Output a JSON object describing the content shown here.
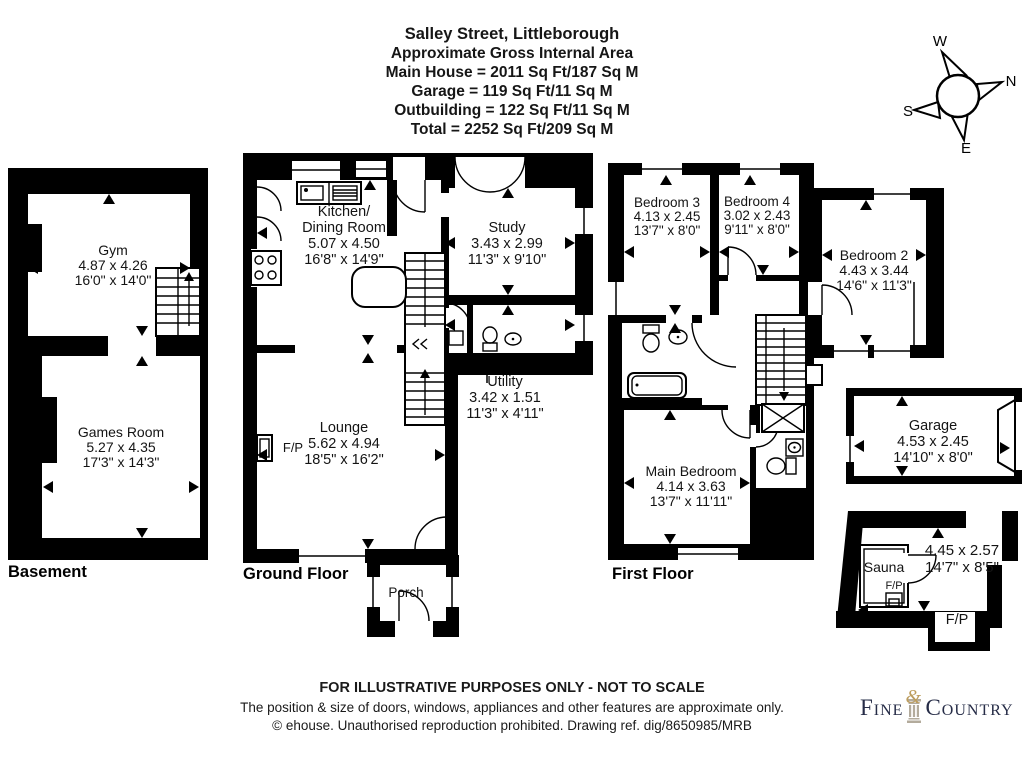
{
  "title": {
    "address": "Salley Street, Littleborough",
    "subtitle": "Approximate Gross Internal Area",
    "lines": [
      "Main House = 2011 Sq Ft/187 Sq M",
      "Garage = 119 Sq Ft/11 Sq M",
      "Outbuilding = 122 Sq Ft/11 Sq M",
      "Total = 2252 Sq Ft/209 Sq M"
    ]
  },
  "compass": {
    "n": "N",
    "e": "E",
    "s": "S",
    "w": "W"
  },
  "floor_labels": {
    "basement": "Basement",
    "ground": "Ground Floor",
    "first": "First Floor"
  },
  "rooms": {
    "gym": {
      "name": "Gym",
      "metric": "4.87 x 4.26",
      "imperial": "16'0\" x 14'0\""
    },
    "games_room": {
      "name": "Games Room",
      "metric": "5.27 x 4.35",
      "imperial": "17'3\" x 14'3\""
    },
    "kitchen": {
      "name1": "Kitchen/",
      "name2": "Dining Room",
      "metric": "5.07 x 4.50",
      "imperial": "16'8\" x 14'9\""
    },
    "study": {
      "name": "Study",
      "metric": "3.43 x 2.99",
      "imperial": "11'3\" x 9'10\""
    },
    "utility": {
      "name": "Utility",
      "metric": "3.42 x 1.51",
      "imperial": "11'3\" x 4'11\""
    },
    "lounge": {
      "name": "Lounge",
      "metric": "5.62 x 4.94",
      "imperial": "18'5\" x 16'2\""
    },
    "porch": {
      "name": "Porch"
    },
    "bedroom3": {
      "name": "Bedroom 3",
      "metric": "4.13 x 2.45",
      "imperial": "13'7\" x 8'0\""
    },
    "bedroom4": {
      "name": "Bedroom 4",
      "metric": "3.02 x 2.43",
      "imperial": "9'11\" x 8'0\""
    },
    "bedroom2": {
      "name": "Bedroom 2",
      "metric": "4.43 x 3.44",
      "imperial": "14'6\" x 11'3\""
    },
    "main_bedroom": {
      "name": "Main Bedroom",
      "metric": "4.14 x 3.63",
      "imperial": "13'7\" x 11'11\""
    },
    "garage": {
      "name": "Garage",
      "metric": "4.53 x 2.45",
      "imperial": "14'10\" x 8'0\""
    },
    "sauna": {
      "name": "Sauna",
      "metric": "4.45 x 2.57",
      "imperial": "14'7\" x 8'5\""
    }
  },
  "fireplace": {
    "label": "F/P"
  },
  "footer": {
    "line1": "FOR ILLUSTRATIVE PURPOSES ONLY - NOT TO SCALE",
    "line2": "The position & size of doors, windows, appliances and other features are approximate only.",
    "line3": "© ehouse. Unauthorised reproduction prohibited. Drawing ref. dig/8650985/MRB"
  },
  "logo": {
    "fine": "Fine",
    "amp": "&",
    "country": "Country"
  }
}
